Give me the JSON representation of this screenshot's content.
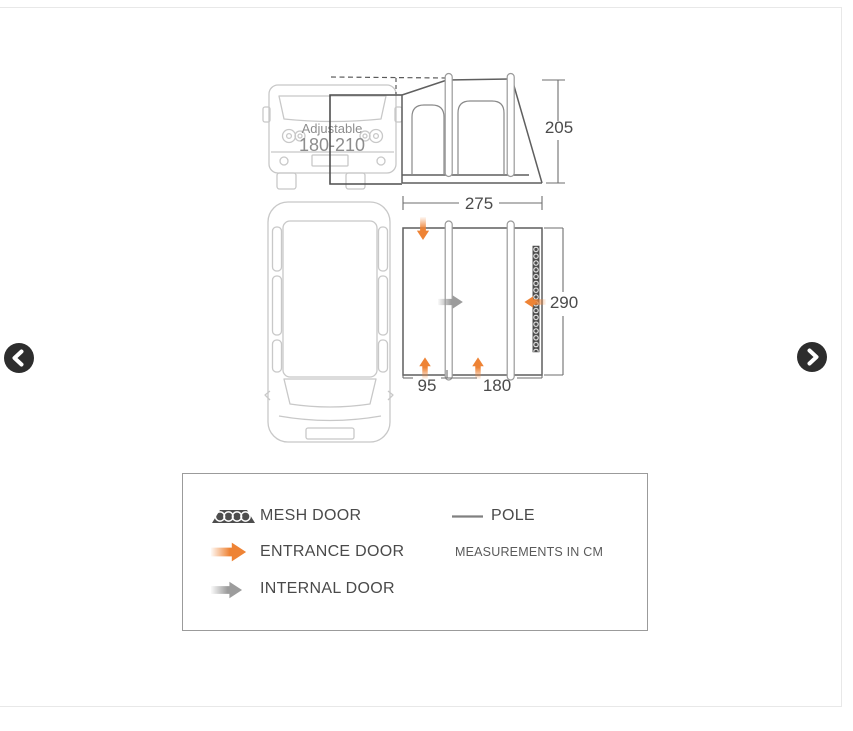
{
  "carousel": {
    "prev_icon": "chevron-left",
    "next_icon": "chevron-right"
  },
  "diagram": {
    "van_note": {
      "line1": "Adjustable",
      "line2": "180-210"
    },
    "dimensions": {
      "height": "205",
      "width": "275",
      "depth": "290",
      "left_section": "95",
      "right_section": "180"
    }
  },
  "legend": {
    "items": [
      {
        "icon": "mesh-swatch",
        "label": "MESH DOOR"
      },
      {
        "icon": "entrance-arrow",
        "label": "ENTRANCE DOOR"
      },
      {
        "icon": "internal-arrow",
        "label": "INTERNAL DOOR"
      }
    ],
    "pole": {
      "icon": "pole-line",
      "label": "POLE"
    },
    "note": "MEASUREMENTS IN CM"
  },
  "colors": {
    "entrance_orange": "#ee8335",
    "internal_gray": "#9c9c9c",
    "pole_gray": "#808080",
    "mesh_dark": "#4d4d4d",
    "line_gray": "#5f5f5f",
    "van_gray": "#c8c8c8",
    "nav_button": "#2d2d2d"
  }
}
